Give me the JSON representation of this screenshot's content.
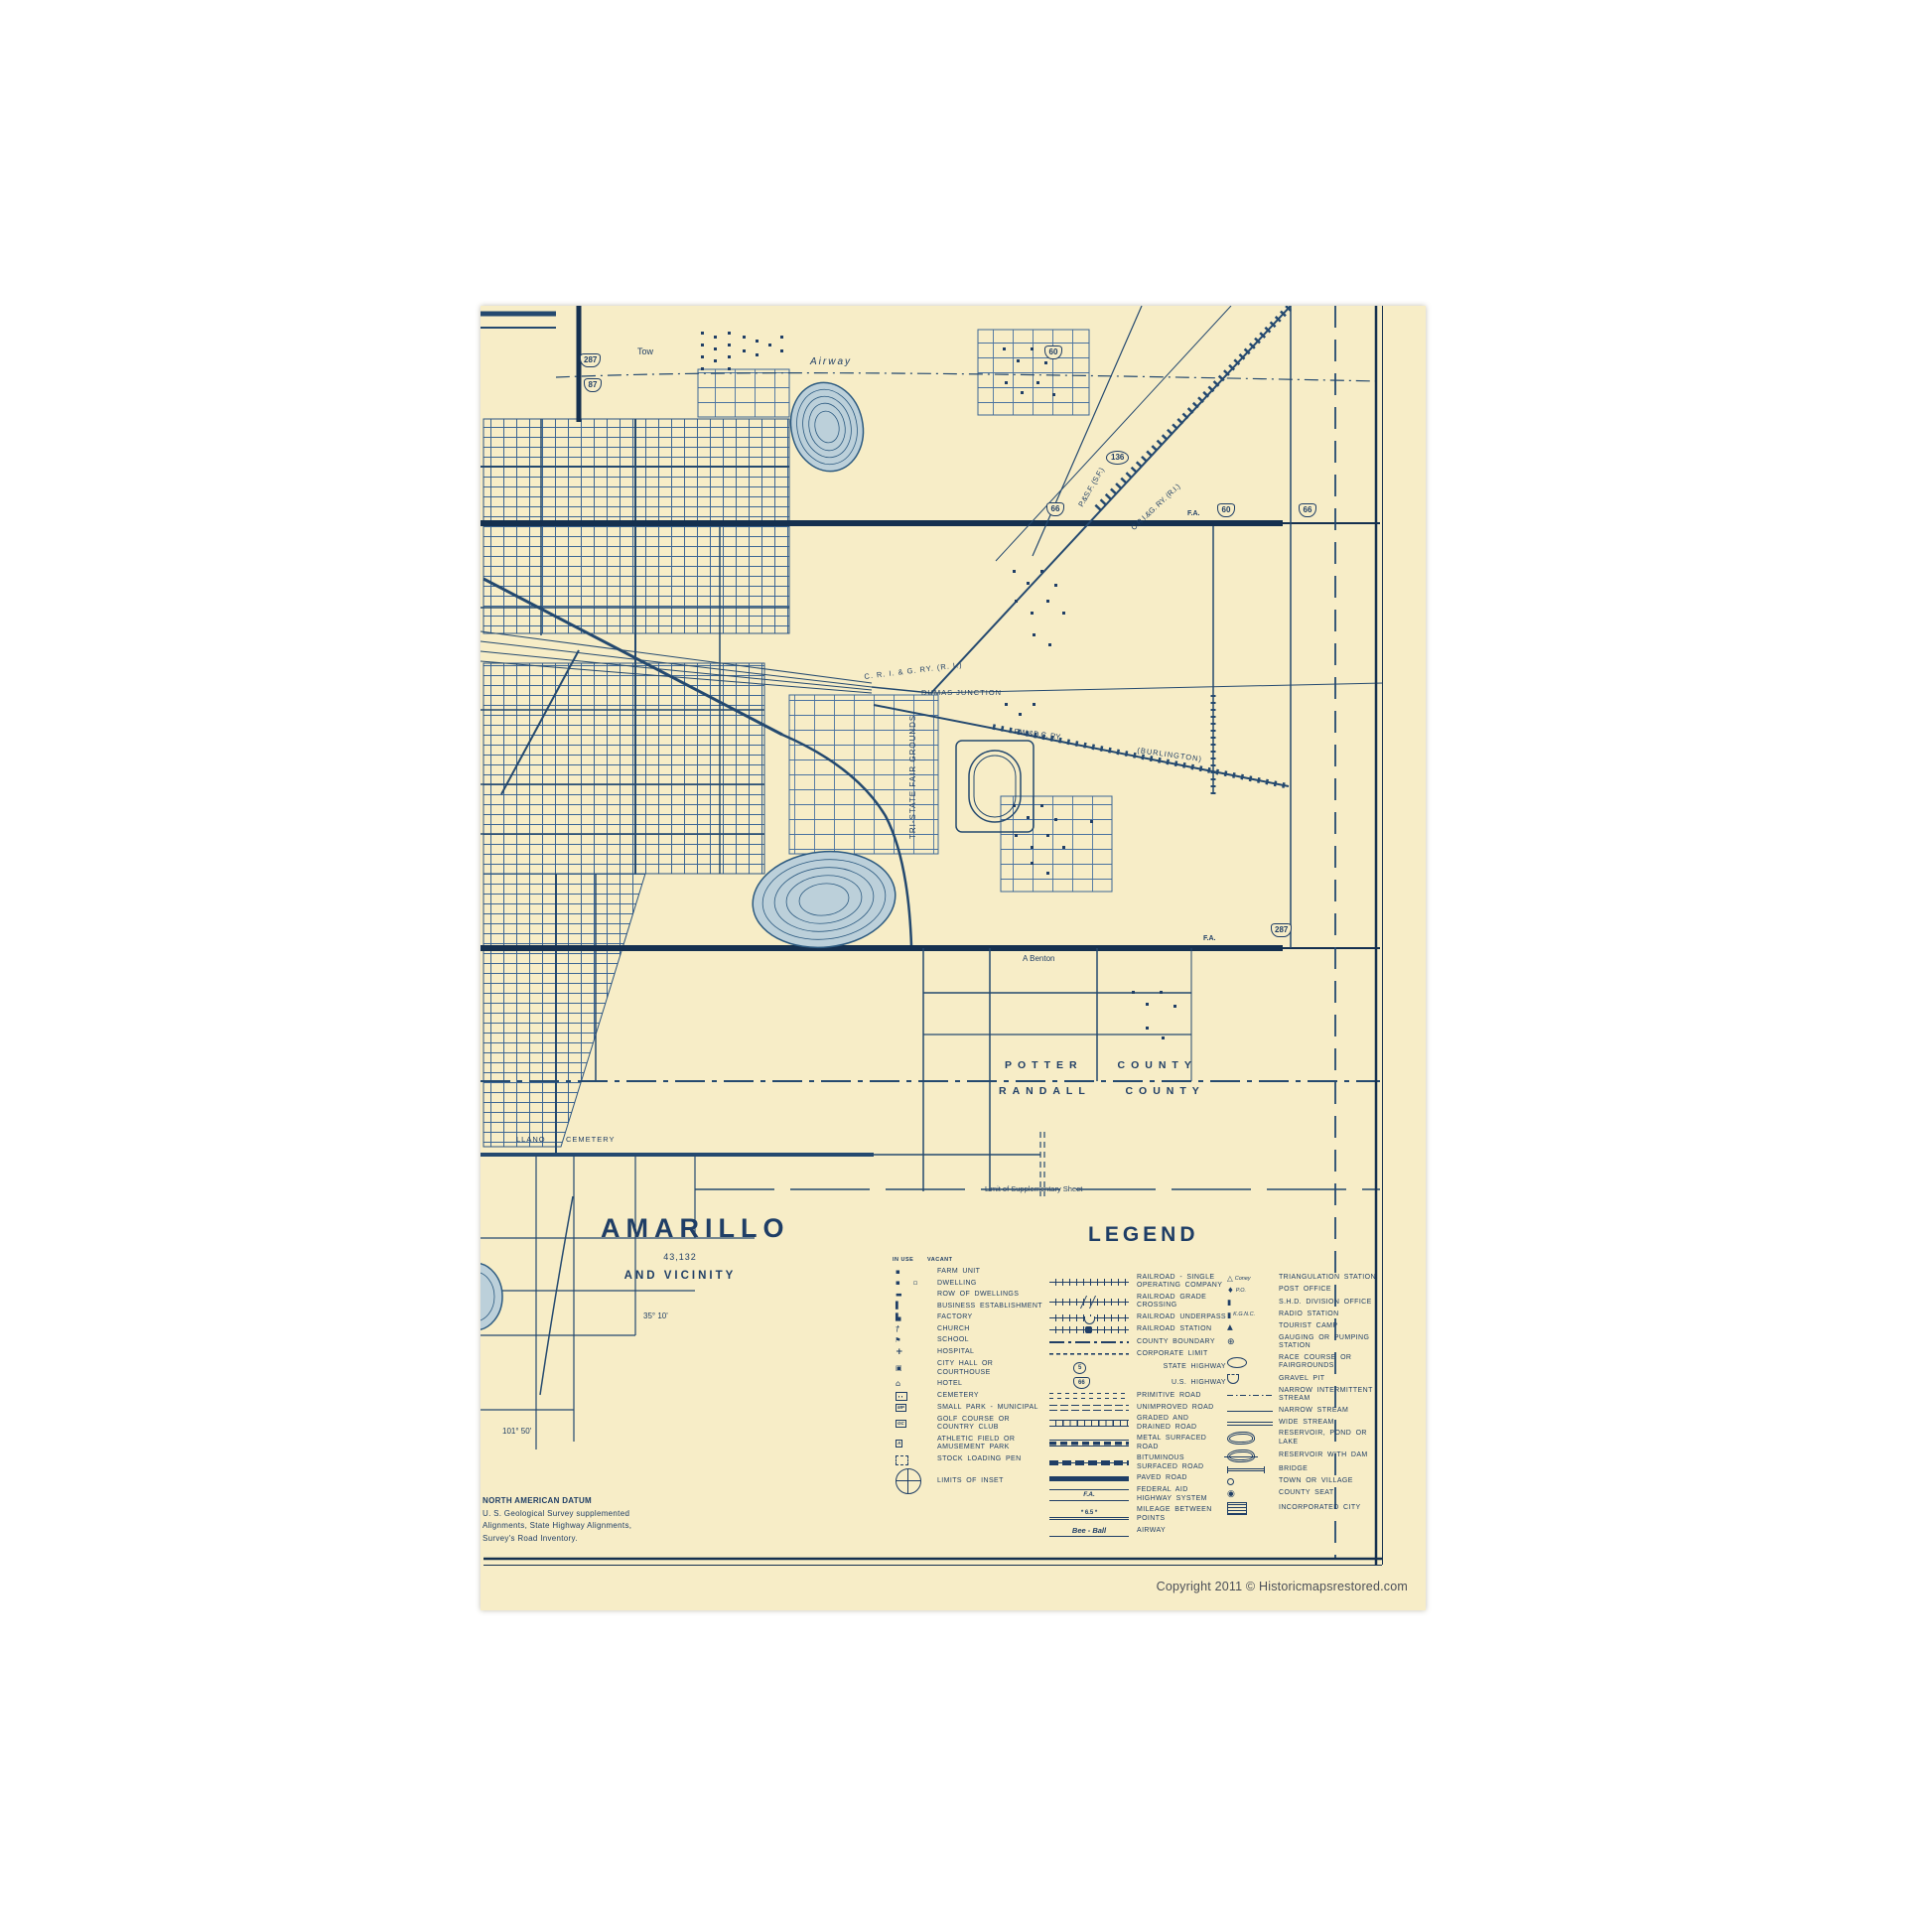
{
  "title_block": {
    "city": "AMARILLO",
    "population": "43,132",
    "subtitle": "AND VICINITY"
  },
  "legend": {
    "title": "LEGEND",
    "in_use": "IN USE",
    "vacant": "VACANT",
    "col1": [
      {
        "sym": "farm-unit",
        "glyph": "▪",
        "label": "FARM UNIT"
      },
      {
        "sym": "dwelling",
        "glyph": "▪",
        "vacant_glyph": "▫",
        "label": "DWELLING"
      },
      {
        "sym": "row-of-dwellings",
        "glyph": "▬",
        "label": "ROW OF DWELLINGS"
      },
      {
        "sym": "business-establishment",
        "glyph": "▌",
        "label": "BUSINESS ESTABLISHMENT"
      },
      {
        "sym": "factory",
        "glyph": "▙",
        "label": "FACTORY"
      },
      {
        "sym": "church",
        "glyph": "†",
        "label": "CHURCH"
      },
      {
        "sym": "school",
        "glyph": "⚑",
        "label": "SCHOOL"
      },
      {
        "sym": "hospital",
        "glyph": "+",
        "label": "HOSPITAL"
      },
      {
        "sym": "city-hall",
        "glyph": "▣",
        "label": "CITY HALL OR COURTHOUSE"
      },
      {
        "sym": "hotel",
        "glyph": "⌂",
        "label": "HOTEL"
      },
      {
        "sym": "cemetery",
        "glyph": "",
        "label": "CEMETERY"
      },
      {
        "sym": "small-park",
        "glyph": "MP",
        "label": "SMALL PARK - MUNICIPAL"
      },
      {
        "sym": "golf-course",
        "glyph": "GC",
        "label": "GOLF COURSE OR COUNTRY CLUB"
      },
      {
        "sym": "athletic-field",
        "glyph": "A",
        "label": "ATHLETIC FIELD OR AMUSEMENT PARK"
      },
      {
        "sym": "stock-loading-pen",
        "glyph": "",
        "label": "STOCK LOADING PEN"
      },
      {
        "sym": "limits-of-inset",
        "glyph": "",
        "label": "LIMITS OF INSET"
      }
    ],
    "col2": [
      {
        "sym": "railroad-single",
        "glyph": "",
        "label": "RAILROAD - SINGLE OPERATING COMPANY"
      },
      {
        "sym": "railroad-grade-crossing",
        "glyph": "",
        "label": "RAILROAD GRADE CROSSING"
      },
      {
        "sym": "railroad-underpass",
        "glyph": "",
        "label": "RAILROAD UNDERPASS"
      },
      {
        "sym": "railroad-station",
        "glyph": "",
        "label": "RAILROAD STATION"
      },
      {
        "sym": "county-boundary",
        "glyph": "",
        "label": "COUNTY BOUNDARY"
      },
      {
        "sym": "corporate-limit",
        "glyph": "",
        "label": "CORPORATE LIMIT"
      },
      {
        "sym": "state-highway",
        "glyph": "5",
        "label": "STATE HIGHWAY"
      },
      {
        "sym": "us-highway",
        "glyph": "66",
        "label": "U.S. HIGHWAY"
      },
      {
        "sym": "primitive-road",
        "glyph": "",
        "label": "PRIMITIVE ROAD"
      },
      {
        "sym": "unimproved-road",
        "glyph": "",
        "label": "UNIMPROVED ROAD"
      },
      {
        "sym": "graded-road",
        "glyph": "",
        "label": "GRADED AND DRAINED ROAD"
      },
      {
        "sym": "metal-road",
        "glyph": "",
        "label": "METAL SURFACED ROAD"
      },
      {
        "sym": "bituminous-road",
        "glyph": "",
        "label": "BITUMINOUS SURFACED ROAD"
      },
      {
        "sym": "paved-road",
        "glyph": "",
        "label": "PAVED ROAD"
      },
      {
        "sym": "federal-aid",
        "glyph": "F.A.",
        "label": "FEDERAL AID HIGHWAY SYSTEM"
      },
      {
        "sym": "mileage",
        "glyph": "*  6.5  *",
        "label": "MILEAGE BETWEEN POINTS"
      },
      {
        "sym": "airway-sample",
        "glyph": "Bee - Ball",
        "label": "AIRWAY"
      }
    ],
    "col3": [
      {
        "sym": "triangulation-station",
        "glyph": "△",
        "sym_text": "Coney",
        "label": "TRIANGULATION STATION"
      },
      {
        "sym": "post-office",
        "glyph": "♦",
        "sym_text": "P.O.",
        "label": "POST OFFICE"
      },
      {
        "sym": "shd-division-office",
        "glyph": "▮",
        "sym_text": "",
        "label": "S.H.D. DIVISION OFFICE"
      },
      {
        "sym": "radio-station",
        "glyph": "▮",
        "sym_text": "K.G.N.C.",
        "label": "RADIO STATION"
      },
      {
        "sym": "tourist-camp",
        "glyph": "▲",
        "sym_text": "",
        "label": "TOURIST CAMP"
      },
      {
        "sym": "gauging-station",
        "glyph": "⊕",
        "sym_text": "",
        "label": "GAUGING OR PUMPING STATION"
      },
      {
        "sym": "race-course",
        "glyph": "",
        "sym_text": "",
        "label": "RACE COURSE OR FAIRGROUNDS"
      },
      {
        "sym": "gravel-pit",
        "glyph": "",
        "sym_text": "",
        "label": "GRAVEL PIT"
      },
      {
        "sym": "narrow-intermittent-stream",
        "glyph": "",
        "sym_text": "",
        "label": "NARROW INTERMITTENT STREAM"
      },
      {
        "sym": "narrow-stream",
        "glyph": "",
        "sym_text": "",
        "label": "NARROW STREAM"
      },
      {
        "sym": "wide-stream",
        "glyph": "",
        "sym_text": "",
        "label": "WIDE STREAM"
      },
      {
        "sym": "reservoir",
        "glyph": "",
        "sym_text": "",
        "label": "RESERVOIR, POND OR LAKE"
      },
      {
        "sym": "reservoir-dam",
        "glyph": "",
        "sym_text": "",
        "label": "RESERVOIR WITH DAM"
      },
      {
        "sym": "bridge",
        "glyph": "",
        "sym_text": "",
        "label": "BRIDGE"
      },
      {
        "sym": "town-village",
        "glyph": "",
        "sym_text": "",
        "label": "TOWN OR VILLAGE"
      },
      {
        "sym": "county-seat",
        "glyph": "◉",
        "sym_text": "",
        "label": "COUNTY SEAT"
      },
      {
        "sym": "incorporated-city",
        "glyph": "",
        "sym_text": "",
        "label": "INCORPORATED CITY"
      }
    ]
  },
  "map_labels": {
    "tow": "Tow",
    "airway": "Airway",
    "psf_railroad": "P.&S.F.  (S.F.)",
    "crig_railroad_ne": "C.R.I.&G.  RY.  (R.I.)",
    "crig_railroad": "C. R. I. & G.     RY.     (R. I.)",
    "dumas_junction": "DUMAS  JUNCTION",
    "fwdc_railroad": "F.W.&D.C.    RY.",
    "burlington": "(BURLINGTON)",
    "tri_state_fairgrounds": "TRI-STATE FAIR GROUNDS",
    "a_benton": "A Benton",
    "fa": "F.A.",
    "potter_county": "POTTER  COUNTY",
    "randall_county": "RANDALL  COUNTY",
    "limit_sheet": "Limit  of  Supplementary  Sheet",
    "llano": "LLANO",
    "cemetery": "CEMETERY",
    "latitude": "35° 10'",
    "longitude": "101° 50'"
  },
  "shields": {
    "us287": "287",
    "us87": "87",
    "us60": "60",
    "us66": "66",
    "state136": "136"
  },
  "notes": {
    "datum": "NORTH  AMERICAN  DATUM",
    "line2": "U. S. Geological Survey supplemented",
    "line3": "Alignments, State Highway Alignments,",
    "line4": "Survey's Road Inventory."
  },
  "footer": {
    "copyright": "Copyright 2011 ©  Historicmapsrestored.com"
  }
}
